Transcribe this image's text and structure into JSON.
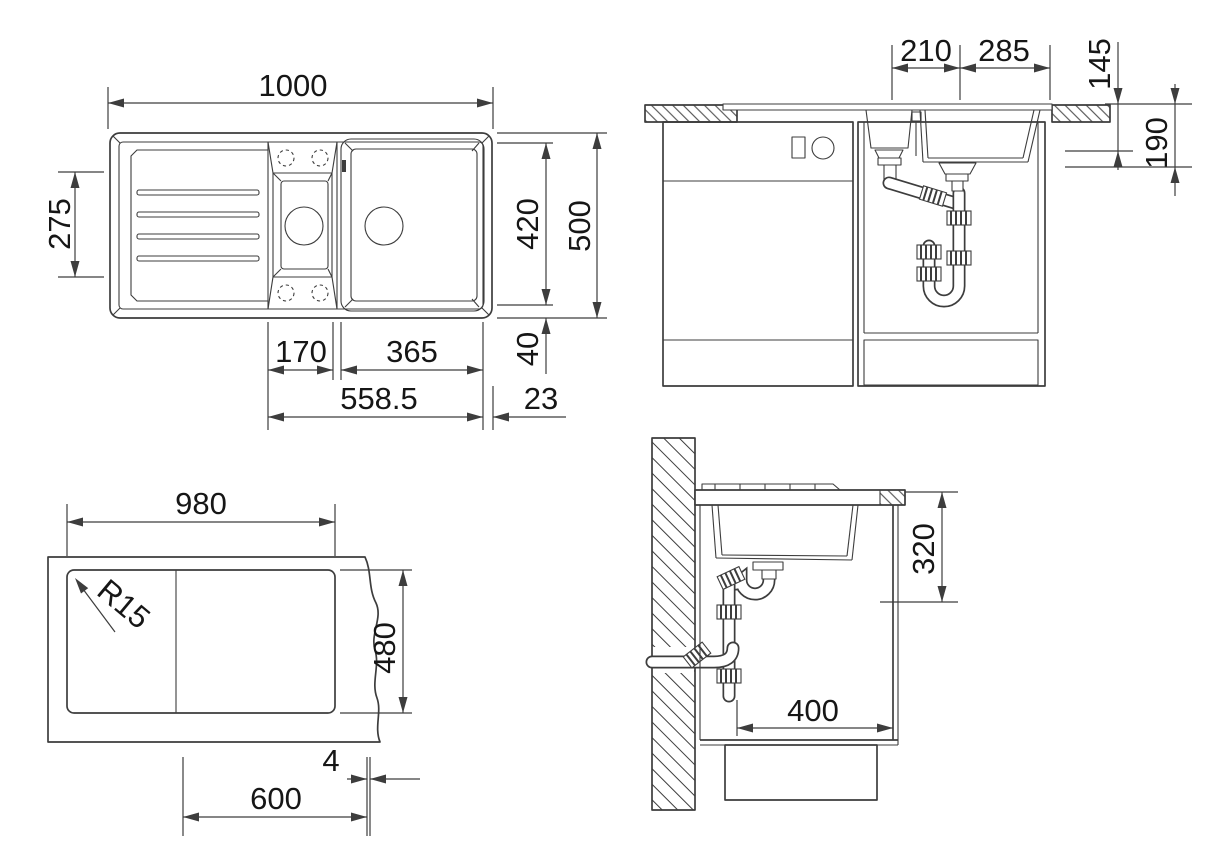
{
  "drawing": {
    "kind": "technical-dimension-drawing",
    "subject": "inset kitchen sink with drainer, bowl sections, cabinet installation and cutout template"
  },
  "colors": {
    "ink": "#3d3d3d",
    "text": "#161616",
    "background": "#ffffff"
  },
  "views": {
    "plan": {
      "label": "plan-view",
      "dims": {
        "overall_width": "1000",
        "drainer_depth": "275",
        "inner_depth": "420",
        "overall_depth": "500",
        "rim_margin": "40",
        "small_bowl_width": "170",
        "main_bowl_width": "365",
        "bowl_span": "558.5",
        "edge_gap": "23"
      }
    },
    "front": {
      "label": "front-elevation",
      "dims": {
        "drain_spacing": "210",
        "drain_to_edge": "285",
        "small_bowl_depth": "145",
        "main_bowl_depth": "190"
      }
    },
    "cutout": {
      "label": "cutout-template",
      "dims": {
        "width": "980",
        "depth": "480",
        "corner_radius": "R15",
        "gap": "4",
        "cabinet_width": "600"
      }
    },
    "side": {
      "label": "side-section",
      "dims": {
        "trap_depth": "320",
        "wall_clearance": "400"
      }
    }
  }
}
